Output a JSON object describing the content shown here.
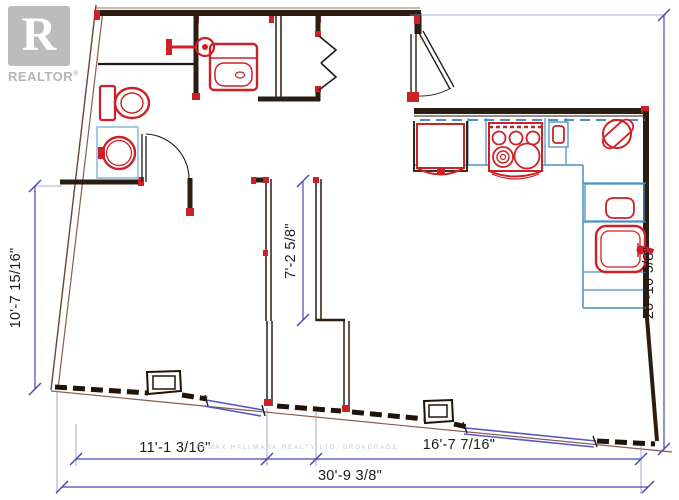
{
  "logo": {
    "mark_letter": "R",
    "brand": "REALTOR",
    "registered_symbol": "®"
  },
  "dimensions": {
    "left": "10'-7 15/16\"",
    "center_shaft": "7'-2 5/8\"",
    "right": "20'-10 5/8\"",
    "bottom_left": "11'-1 3/16\"",
    "bottom_right": "16'-7 7/16\"",
    "bottom_overall": "30'-9 3/8\""
  },
  "watermark": {
    "text": "REMAX HALLMARK REALTY LTD. BROKERAGE"
  },
  "colors": {
    "wall_dark": "#2b1d12",
    "fixture_red": "#cc2127",
    "counter_blue": "#4a90c4",
    "vanity_blue": "#8fbcd9",
    "dimension_blue": "#4646b4",
    "window_blue": "#5558c0",
    "boundary_brown": "#8a5a50",
    "logo_gray": "#bcbcbc",
    "watermark_gray": "#c6ccd6"
  },
  "icons": [
    "realtor-logo",
    "shower-icon",
    "toilet-icon",
    "vanity-sink-icon",
    "bathtub-icon",
    "bathroom-door-icon",
    "bifold-closet-door-icon",
    "entry-door-icon",
    "fridge-icon",
    "stove-icon",
    "range-control-icon",
    "corner-sink-icon",
    "dishwasher-icon",
    "kitchen-sink-icon",
    "window-icon",
    "column-icon"
  ]
}
